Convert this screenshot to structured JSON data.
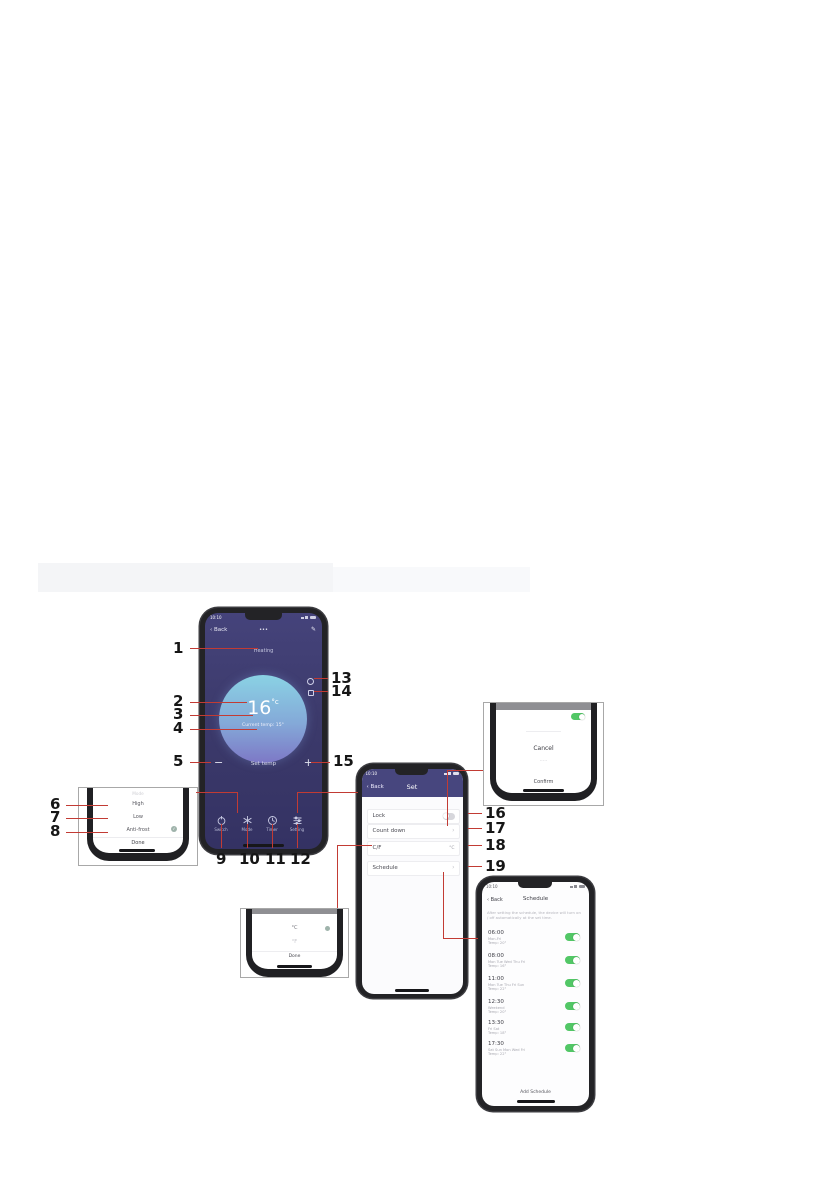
{
  "callouts": {
    "c1": "1",
    "c2": "2",
    "c3": "3",
    "c4": "4",
    "c5": "5",
    "c6": "6",
    "c7": "7",
    "c8": "8",
    "c9": "9",
    "c10": "10",
    "c11": "11",
    "c12": "12",
    "c13": "13",
    "c14": "14",
    "c15": "15",
    "c16": "16",
    "c17": "17",
    "c18": "18",
    "c19": "19"
  },
  "main_phone": {
    "status_time": "10:10",
    "back_label": "Back",
    "title": "•••",
    "edit_icon": "✎",
    "mode_label": "Heating",
    "temp_value": "16",
    "temp_unit": "°c",
    "temp_sub": "Current temp: 15°",
    "minus": "−",
    "set_label": "Set temp",
    "plus": "+",
    "nav": [
      {
        "label": "Switch"
      },
      {
        "label": "Mode"
      },
      {
        "label": "Timer"
      },
      {
        "label": "Setting"
      }
    ]
  },
  "mode_sheet": {
    "title": "Mode",
    "options": [
      {
        "label": "High"
      },
      {
        "label": "Low"
      },
      {
        "label": "Anti-frost"
      }
    ],
    "done": "Done"
  },
  "set_phone": {
    "status_time": "10:10",
    "back_label": "Back",
    "title": "Set",
    "rows": [
      {
        "label": "Lock",
        "control": ""
      },
      {
        "label": "Count down",
        "control": "›"
      },
      {
        "label": "C/F",
        "control": "°C"
      },
      {
        "label": "Schedule",
        "control": "›"
      }
    ]
  },
  "countdown_sheet": {
    "selected": "Cancel",
    "below_text": "·····",
    "confirm": "Confirm"
  },
  "cf_sheet": {
    "options": [
      {
        "label": "°C"
      },
      {
        "label": "°F"
      }
    ],
    "done": "Done"
  },
  "schedule_phone": {
    "status_time": "10:10",
    "back_label": "Back",
    "title": "Schedule",
    "note": "After setting the schedule, the device will turn on / off automatically at the set time.",
    "entries": [
      {
        "time": "06:00",
        "days": "Mon-Fri",
        "temp": "Temp: 20°"
      },
      {
        "time": "08:00",
        "days": "Mon Tue Wed Thu Fri",
        "temp": "Temp: 16°"
      },
      {
        "time": "11:00",
        "days": "Mon Tue Thu Fri Sun",
        "temp": "Temp: 22°"
      },
      {
        "time": "12:30",
        "days": "Weekend",
        "temp": "Temp: 20°"
      },
      {
        "time": "13:30",
        "days": "Fri Sat",
        "temp": "Temp: 18°"
      },
      {
        "time": "17:30",
        "days": "Sat Sun Mon Wed Fri",
        "temp": "Temp: 22°"
      }
    ],
    "add_button": "Add Schedule"
  },
  "colors": {
    "header_purple": "#47467e",
    "screen_purple": "#3c3a6b",
    "toggle_green": "#52c766",
    "callout_red": "#c23b34"
  }
}
